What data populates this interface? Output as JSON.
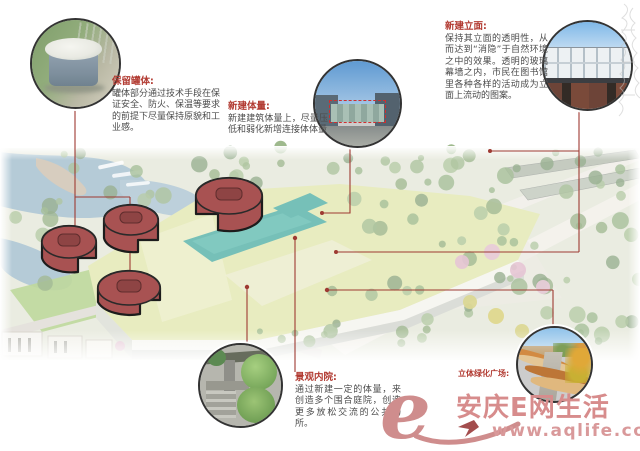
{
  "callouts": [
    {
      "id": "retain-tanks",
      "title": "保留罐体:",
      "body": "罐体部分通过技术手段在保证安全、防火、保温等要求的前提下尽量保持原貌和工业感。"
    },
    {
      "id": "new-volume",
      "title": "新建体量:",
      "body": "新建建筑体量上，尽量压低和弱化新增连接体体量"
    },
    {
      "id": "new-facade",
      "title": "新建立面:",
      "body": "保持其立面的透明性，从而达到“消隐”于自然环境之中的效果。透明的玻璃幕墙之内，市民在图书馆里各种各样的活动成为立面上流动的图案。"
    },
    {
      "id": "courtyard",
      "title": "景观内院:",
      "body": "通过新建一定的体量，来创造多个围合庭院，创造更多放松交流的公共场所。"
    },
    {
      "id": "green-plaza",
      "title": "立体绿化广场:",
      "body": ""
    }
  ],
  "watermark": {
    "logo_glyph": "e",
    "site_name": "安庆E网生活",
    "site_url": "www.aqlife.com"
  },
  "colors": {
    "callout_title_red": "#b23b32",
    "callout_line_red": "#9e3a32",
    "tank_highlight_red": "#a85252",
    "pool_teal": "#2fa094",
    "roof_green": "#dce2a0",
    "watermark_pink": "#d68f8f"
  }
}
